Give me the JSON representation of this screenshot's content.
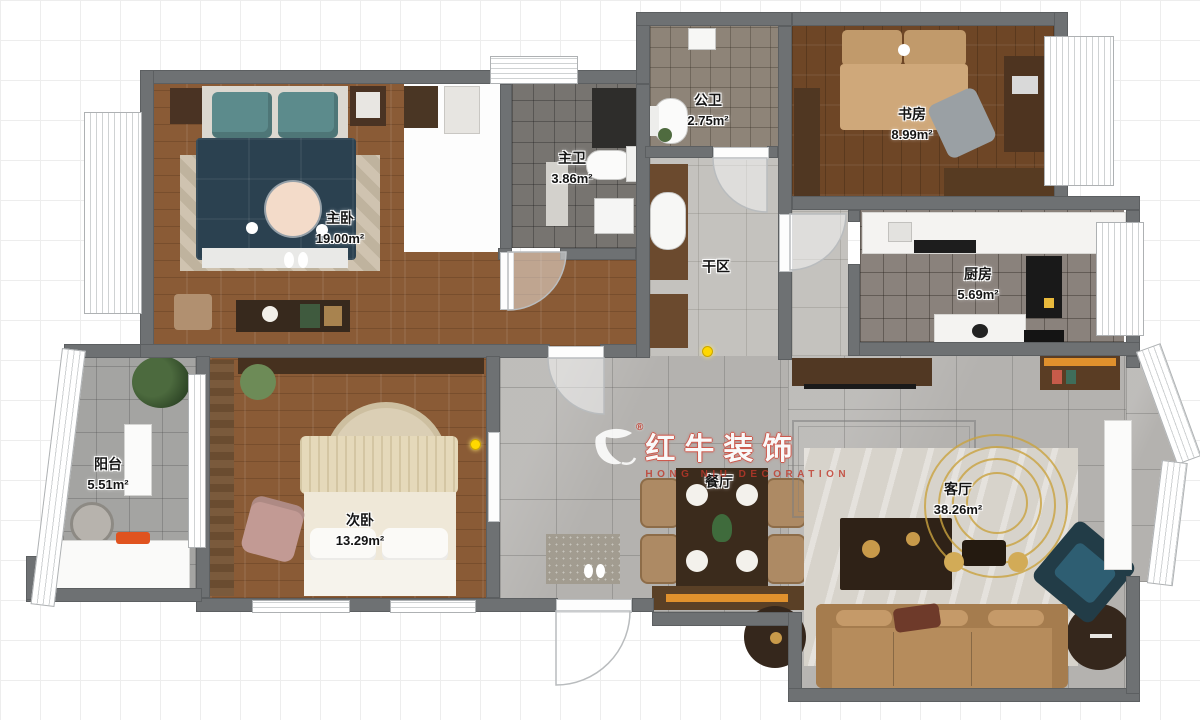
{
  "watermark": {
    "brand": "红牛装饰",
    "subtitle": "HONG NIU DECORATION",
    "registered": "®",
    "logo": "bull-logo"
  },
  "rooms": [
    {
      "id": "master-bedroom",
      "name": "主卧",
      "area": "19.00m²"
    },
    {
      "id": "master-bath",
      "name": "主卫",
      "area": "3.86m²"
    },
    {
      "id": "public-bath",
      "name": "公卫",
      "area": "2.75m²"
    },
    {
      "id": "study",
      "name": "书房",
      "area": "8.99m²"
    },
    {
      "id": "kitchen",
      "name": "厨房",
      "area": "5.69m²"
    },
    {
      "id": "dry-area",
      "name": "干区",
      "area": ""
    },
    {
      "id": "balcony",
      "name": "阳台",
      "area": "5.51m²"
    },
    {
      "id": "second-bedroom",
      "name": "次卧",
      "area": "13.29m²"
    },
    {
      "id": "dining-room",
      "name": "餐厅",
      "area": ""
    },
    {
      "id": "living-room",
      "name": "客厅",
      "area": "38.26m²"
    }
  ],
  "colors": {
    "wall": "#6e7173",
    "wood": "#8a5b36",
    "wood_dark": "#6e4626",
    "tile_gray": "#b4b2af",
    "accent_yellow": "#ffd800",
    "brand_red": "#c0392b",
    "teal": "#5c8b8c",
    "navy": "#2b4150",
    "tan": "#b68c5c",
    "cream": "#efe8d8",
    "accent_orange": "#e0912d"
  }
}
